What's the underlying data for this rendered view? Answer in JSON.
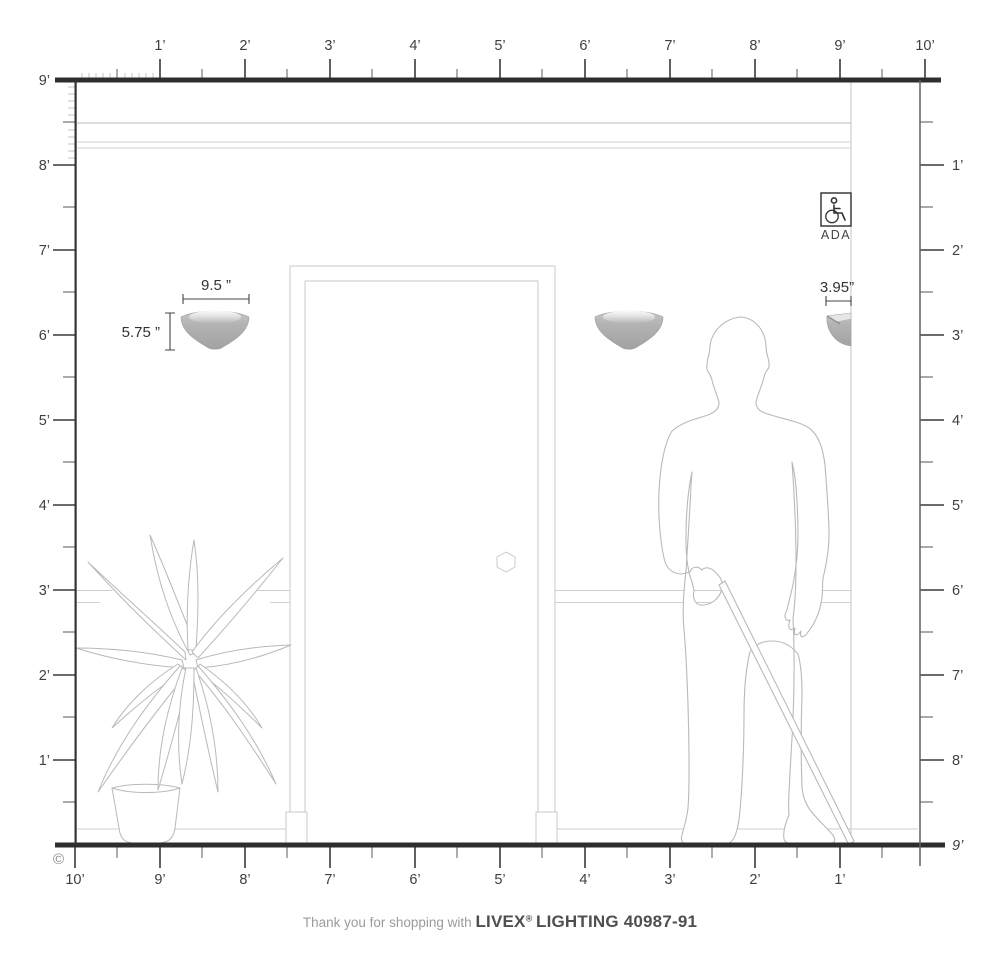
{
  "page": {
    "copyright": "©"
  },
  "footer": {
    "prefix": "Thank you for shopping with",
    "brand": "LIVEX",
    "reg": "®",
    "brand2": "LIGHTING 40987-91"
  },
  "ada": {
    "label": "ADA"
  },
  "dimensions": {
    "fixture_width": "9.5 ”",
    "fixture_height": "5.75 ”",
    "fixture_projection": "3.95”"
  },
  "rulers": {
    "top": [
      "1’",
      "2’",
      "3’",
      "4’",
      "5’",
      "6’",
      "7’",
      "8’",
      "9’",
      "10’"
    ],
    "left": [
      "9’",
      "8’",
      "7’",
      "6’",
      "5’",
      "4’",
      "3’",
      "2’",
      "1’"
    ],
    "right": [
      "1’",
      "2’",
      "3’",
      "4’",
      "5’",
      "6’",
      "7’",
      "8’"
    ],
    "right_floor": "9’",
    "bottom": [
      "10’",
      "9’",
      "8’",
      "7’",
      "6’",
      "5’",
      "4’",
      "3’",
      "2’",
      "1’"
    ]
  },
  "colors": {
    "line_dark": "#2e2e2e",
    "tick_major": "#3a3a3a",
    "tick_minor": "#777777",
    "tick_inch": "#c4c4c4",
    "drawing_light": "#c9c9c9",
    "figure_outline": "#b9b9b9",
    "sconce_gray": "#ababab",
    "label_text": "#3f3f3f"
  }
}
